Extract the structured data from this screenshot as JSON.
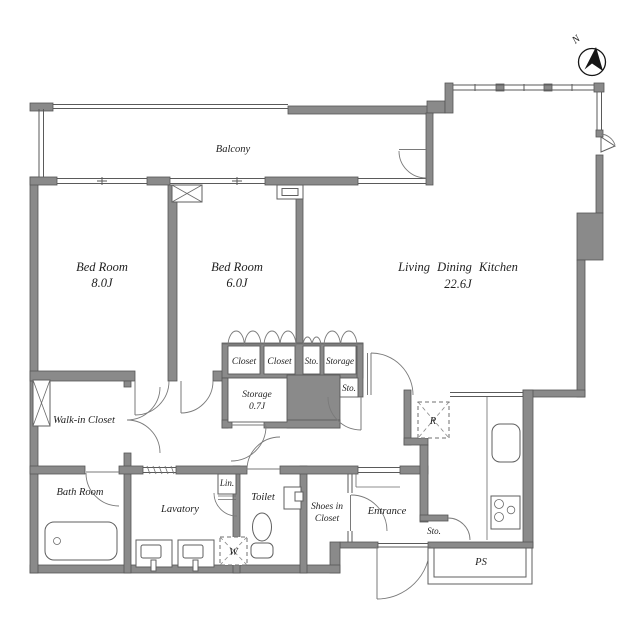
{
  "plan_title": "2LDK apartment floor plan",
  "colors": {
    "wall": "#8a8a8a",
    "line": "#5a5a5a",
    "text": "#1f1f1f",
    "background": "#ffffff"
  },
  "compass": {
    "north_label": "N"
  },
  "rooms": {
    "balcony": "Balcony",
    "bedroom1": {
      "name": "Bed Room",
      "size": "8.0J"
    },
    "bedroom2": {
      "name": "Bed Room",
      "size": "6.0J"
    },
    "ldk": {
      "name": "Living Dining Kitchen",
      "size": "22.6J"
    },
    "walk_in_closet": "Walk-in Closet",
    "bath": "Bath Room",
    "lavatory": "Lavatory",
    "linen": "Lin.",
    "toilet": "Toilet",
    "washer": "W",
    "shoes_closet_line1": "Shoes in",
    "shoes_closet_line2": "Closet",
    "entrance": "Entrance",
    "closet1": "Closet",
    "closet2": "Closet",
    "closet_sto": "Sto.",
    "closet_storage": "Storage",
    "storage": {
      "name": "Storage",
      "size": "0.7J"
    },
    "sto_niche": "Sto.",
    "sto_entrance": "Sto.",
    "pipe_space": "PS",
    "refrigerator": "R"
  }
}
